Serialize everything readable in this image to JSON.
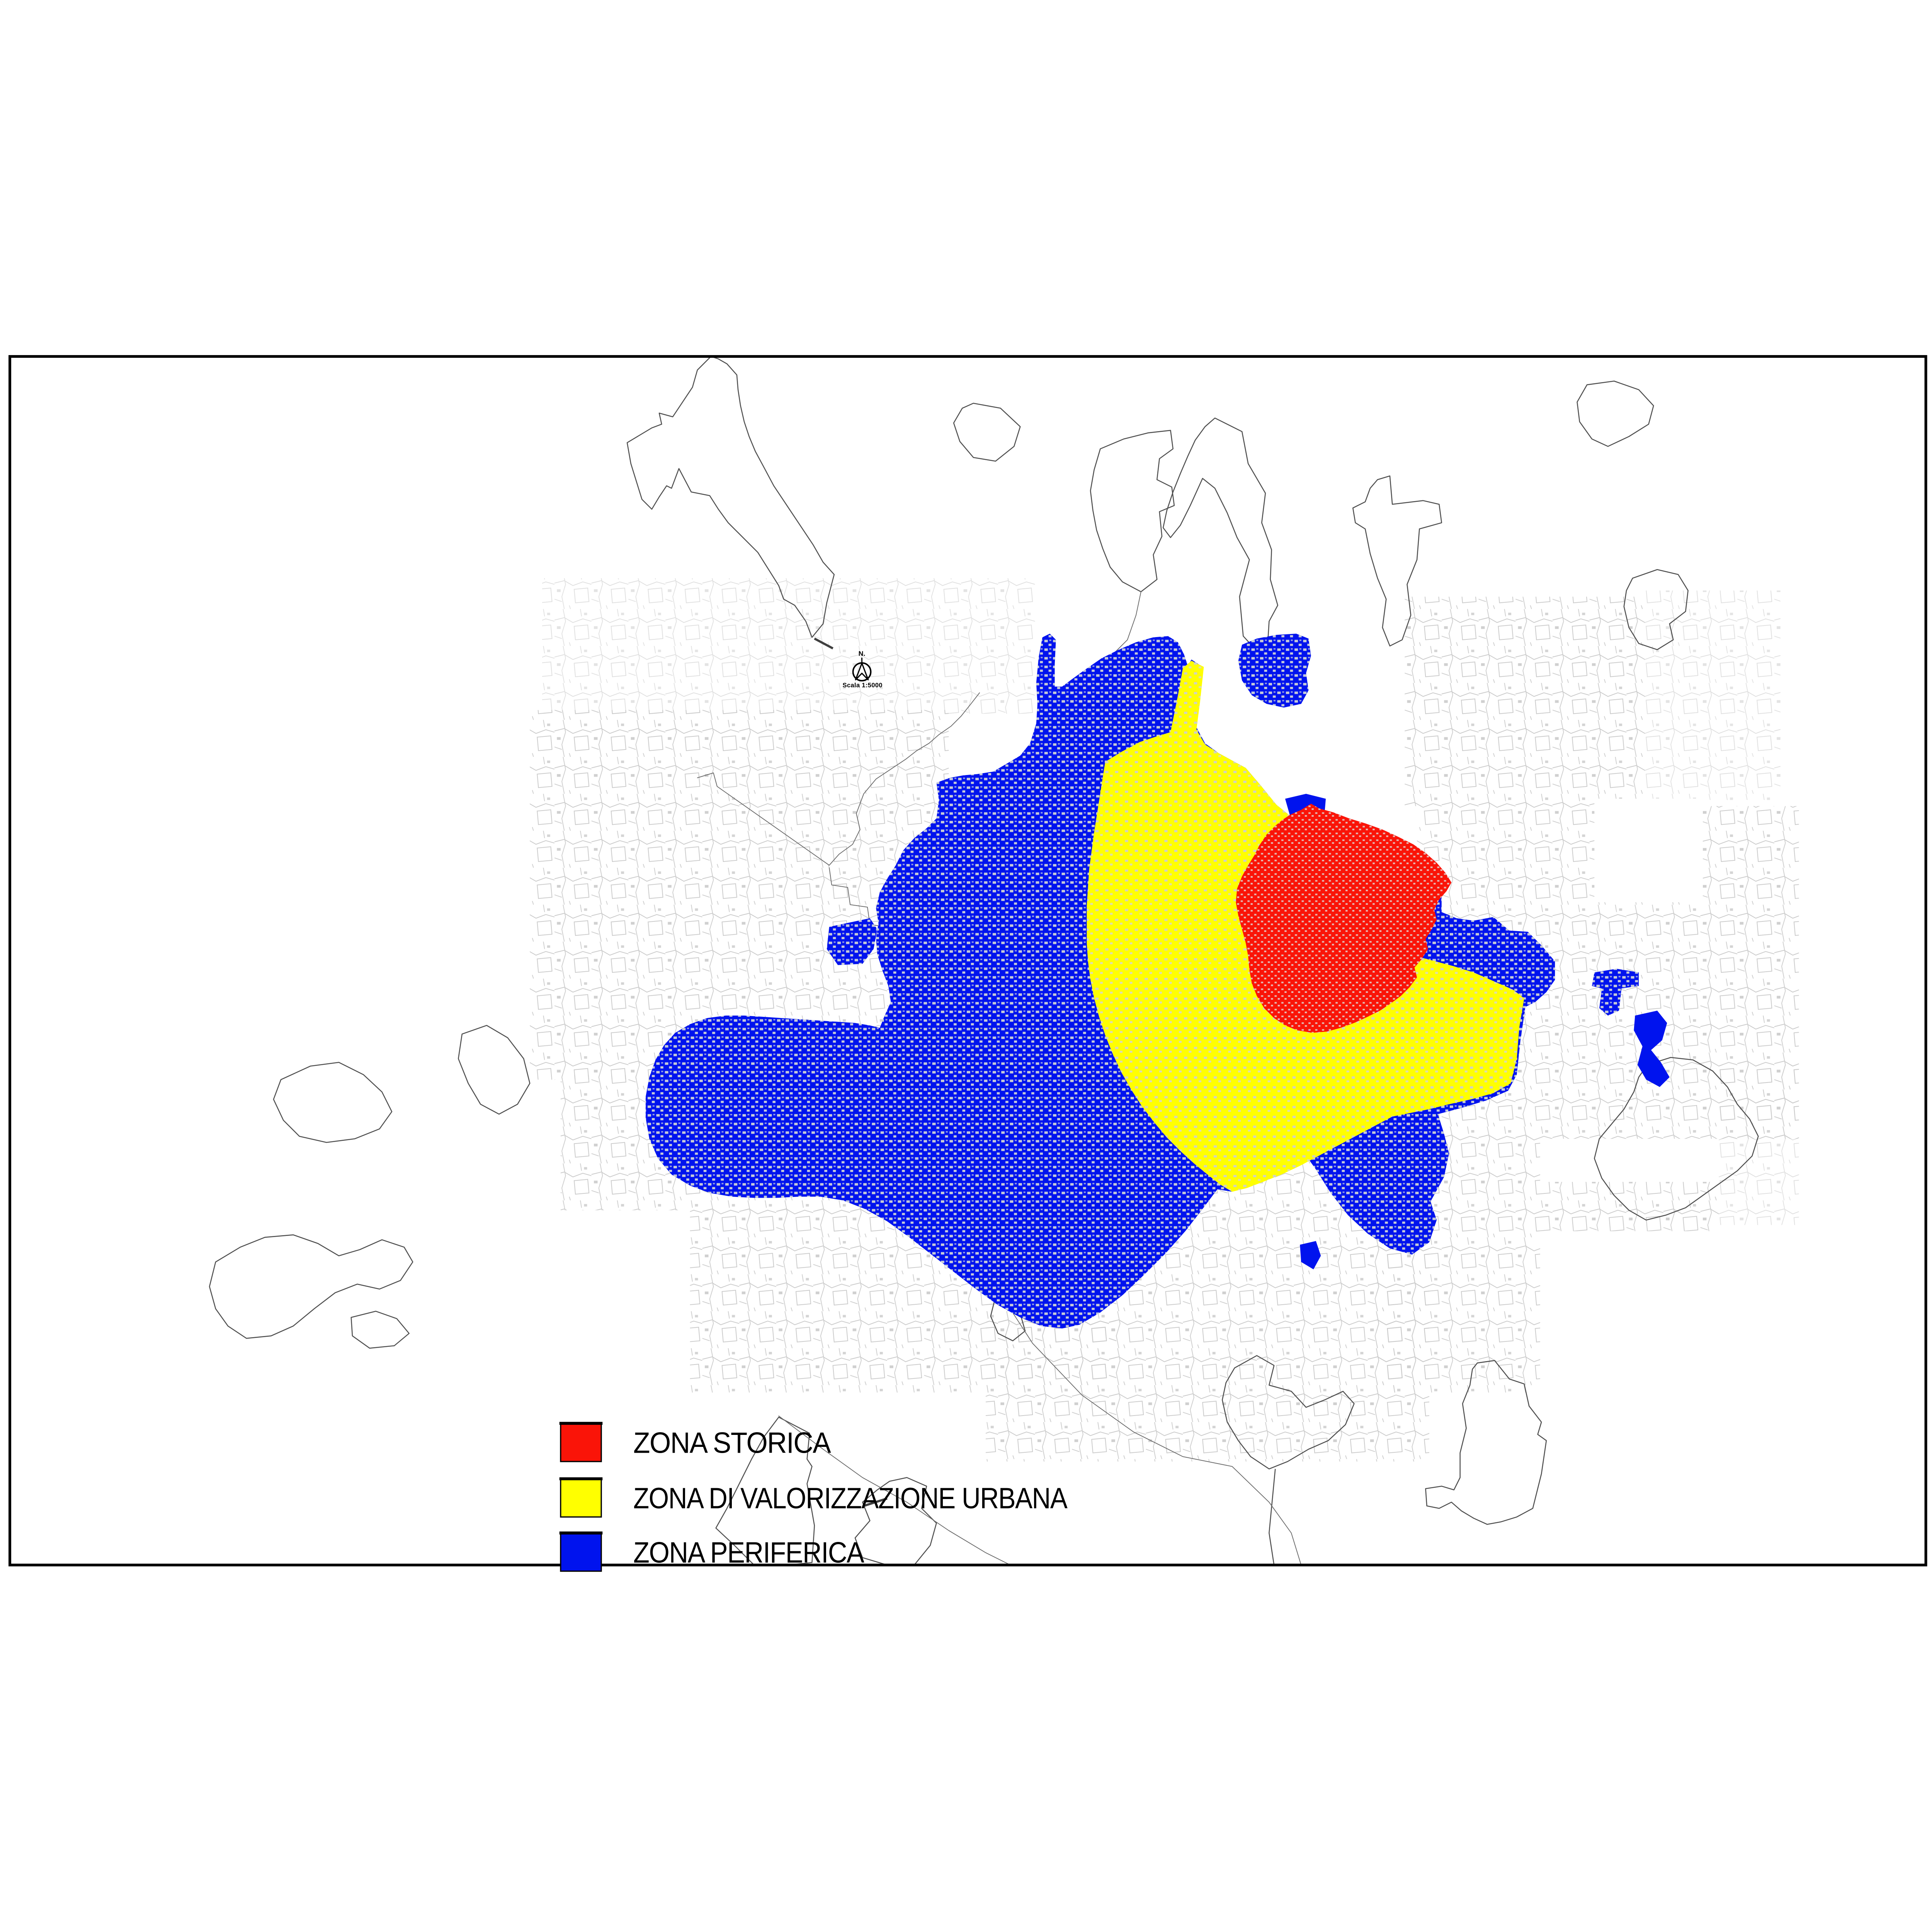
{
  "page": {
    "background_color": "#ffffff",
    "frame_color": "#000000"
  },
  "map": {
    "north_indicator": {
      "label": "N.",
      "scale_label": "Scala 1:5000"
    },
    "texture_color": "#c9c9c9",
    "boundary_line_color": "#4f4f4f"
  },
  "legend": {
    "items": [
      {
        "label": "ZONA STORICA",
        "color": "#fa1408"
      },
      {
        "label": "ZONA DI VALORIZZAZIONE URBANA",
        "color": "#ffff00"
      },
      {
        "label": "ZONA PERIFERICA",
        "color": "#0013ee"
      }
    ]
  }
}
